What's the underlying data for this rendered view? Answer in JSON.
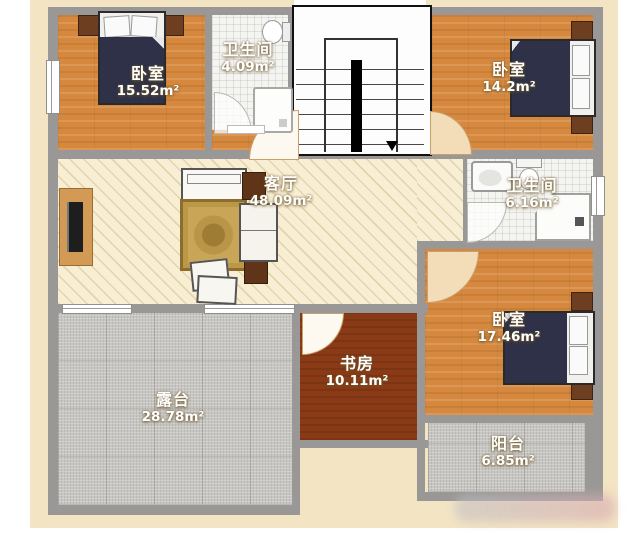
{
  "rooms": [
    {
      "id": "bedroom-top-left",
      "label": "卧室",
      "area": "15.52m²"
    },
    {
      "id": "bathroom-top",
      "label": "卫生间",
      "area": "4.09m²"
    },
    {
      "id": "bedroom-top-right",
      "label": "卧室",
      "area": "14.2m²"
    },
    {
      "id": "living-room",
      "label": "客厅",
      "area": "48.09m²"
    },
    {
      "id": "bathroom-mid",
      "label": "卫生间",
      "area": "6.16m²"
    },
    {
      "id": "bedroom-bottom-right",
      "label": "卧室",
      "area": "17.46m²"
    },
    {
      "id": "study",
      "label": "书房",
      "area": "10.11m²"
    },
    {
      "id": "terrace",
      "label": "露台",
      "area": "28.78m²"
    },
    {
      "id": "balcony",
      "label": "阳台",
      "area": "6.85m²"
    }
  ],
  "palette": {
    "wood_floor": "#d6893e",
    "living_floor": "#f8eed4",
    "study_floor": "#8a3b16",
    "terrace_floor": "#c7c6c2",
    "tile_floor": "#f4f4f1",
    "wall": "#9a9896",
    "exterior_border": "#f3e4c4",
    "bed_blanket": "#2e3148",
    "furniture_wood": "#6e3e20"
  }
}
